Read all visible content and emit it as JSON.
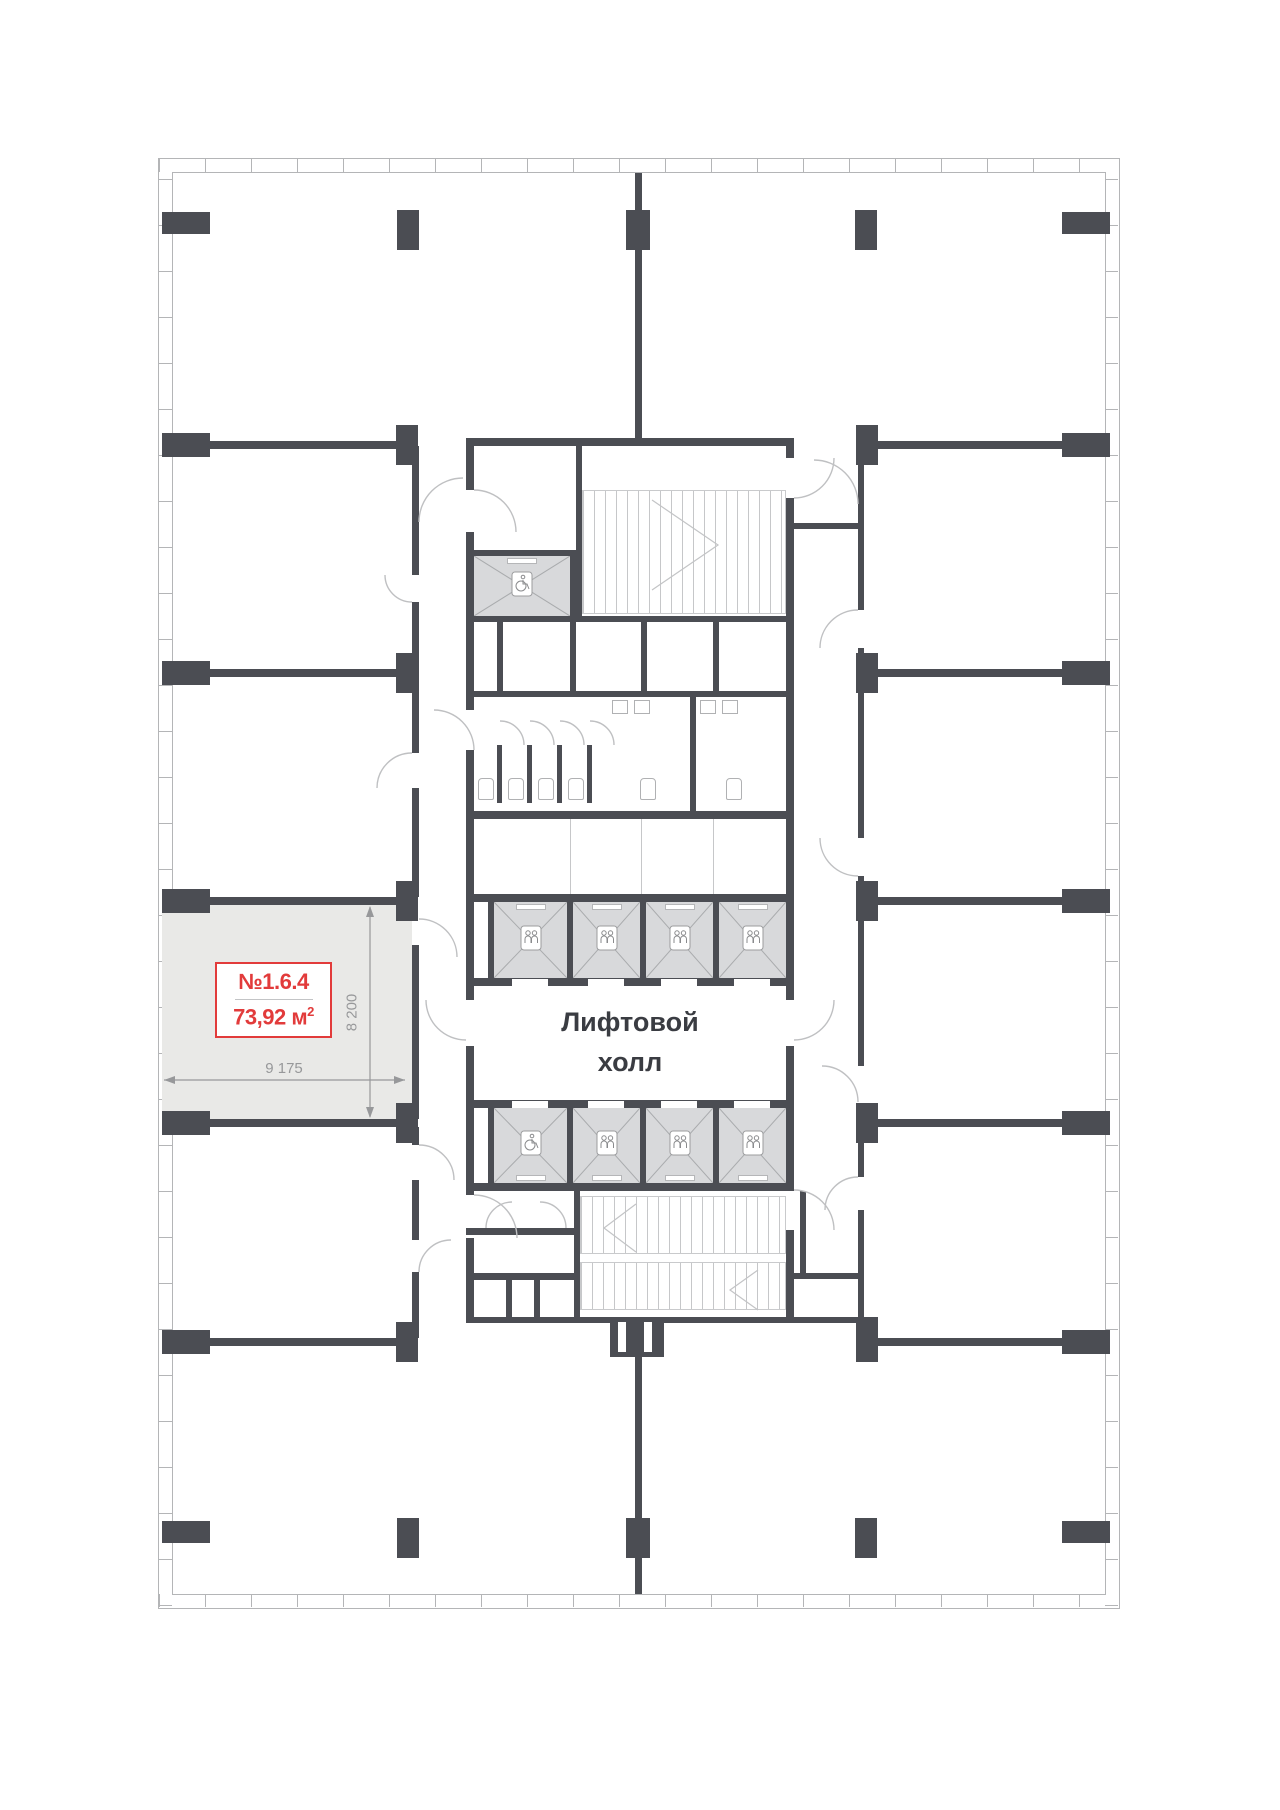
{
  "floorplan": {
    "unit": {
      "number": "№1.6.4",
      "area_main": "73,92 м",
      "area_sup": "2",
      "width_dim": "9 175",
      "height_dim": "8 200"
    },
    "hall": {
      "line1": "Лифтовой",
      "line2": "холл"
    },
    "colors": {
      "wall": "#4b4d53",
      "unit_fill": "#e9e9e7",
      "shaft_fill": "#d8d9db",
      "accent_red": "#e23b3b",
      "dimension_text": "#97989a",
      "light_line": "#bfc0c2"
    }
  }
}
